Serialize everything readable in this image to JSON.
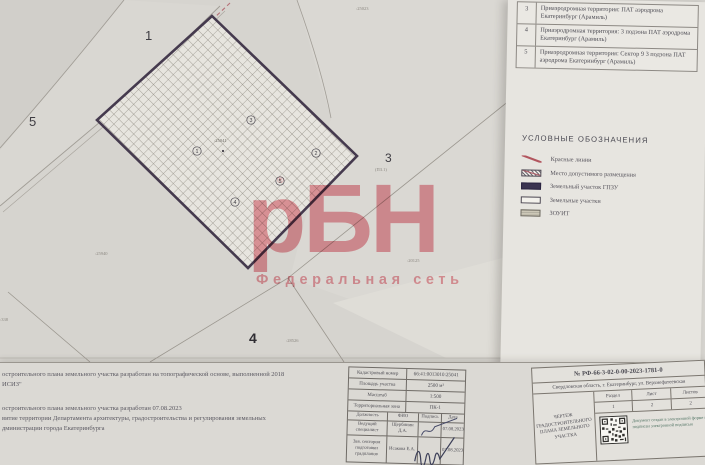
{
  "watermark": {
    "brand": "рБН",
    "reg_mark": "®",
    "subtitle": "Федеральная сеть",
    "color": "#e2929c"
  },
  "zones_table": {
    "rows": [
      {
        "num": "3",
        "text": "Приаэродромная территория: ПАТ аэродрома Екатеринбург (Арамиль)"
      },
      {
        "num": "4",
        "text": "Приаэродромная территория: 3 подзона ПАТ аэродрома Екатеринбург (Арамиль)"
      },
      {
        "num": "5",
        "text": "Приаэродромная территория: Сектор 9 3 подзона ПАТ аэродрома Екатеринбург (Арамиль)"
      }
    ]
  },
  "legend": {
    "title": "УСЛОВНЫЕ ОБОЗНАЧЕНИЯ",
    "items": [
      {
        "icon": "red-line-icon",
        "label": "Красные линии"
      },
      {
        "icon": "hatched-box-icon",
        "label": "Место допустимого размещения"
      },
      {
        "icon": "dark-box-icon",
        "label": "Земельный участок ГПЗУ"
      },
      {
        "icon": "outline-box-icon",
        "label": "Земельные участки"
      },
      {
        "icon": "zouit-box-icon",
        "label": "ЗОУИТ"
      }
    ]
  },
  "map": {
    "region_numbers": [
      "1",
      "5",
      "3",
      "4"
    ],
    "vertex_markers": [
      "3",
      "1",
      "2",
      "5",
      "4"
    ],
    "parcel_label": ":25041",
    "tiny_labels": [
      ":25023",
      "(ПЗ.1)",
      ":25940",
      ":20125",
      ":28526",
      ":338"
    ]
  },
  "notes": {
    "p1_line1": "остроительного плана земельного участка разработан на топографической основе, выполненной 2018",
    "p1_line2": "ИСИЗ\"",
    "p2_line1": "остроительного плана земельного участка разработан 07.08.2023",
    "p2_line2": "витие территории Департамента архитектуры, градостроительства и регулирования земельных",
    "p2_line3": "дминистрации города Екатеринбурга"
  },
  "title_block": {
    "rows": [
      {
        "label": "Кадастровый номер",
        "value": "66:41:0013010:25041"
      },
      {
        "label": "Площадь участка",
        "value": "2500 м²"
      },
      {
        "label": "Масштаб",
        "value": "1:500"
      },
      {
        "label": "Территориальная зона",
        "value": "ПК-1"
      }
    ],
    "sign_header": {
      "position": "Должность",
      "name": "ФИО",
      "signature": "Подпись",
      "date": "Дата"
    },
    "sign_rows": [
      {
        "position": "Ведущий специалист",
        "name": "Щербинин Д.А.",
        "date": "07.08.2023"
      },
      {
        "position": "Зав. сектором подготовки градпланов",
        "name": "Исакова Е.А.",
        "date": "07.08.2023"
      }
    ]
  },
  "doc_block": {
    "number": "№ РФ-66-3-02-0-00-2023-1781-0",
    "address": "Свердловская область, г. Екатеринбург, ул. Верхнефатеевская",
    "drawing_title": "ЧЕРТЕЖ ГРАДОСТРОИТЕЛЬНОГО ПЛАНА ЗЕМЕЛЬНОГО УЧАСТКА",
    "grid": {
      "col1": "Раздел",
      "col2": "Лист",
      "col3": "Листов",
      "v1": "1",
      "v2": "2",
      "v3": "2"
    },
    "stamp_note": "Документ создан в электронной форме и подписан электронной подписью"
  }
}
